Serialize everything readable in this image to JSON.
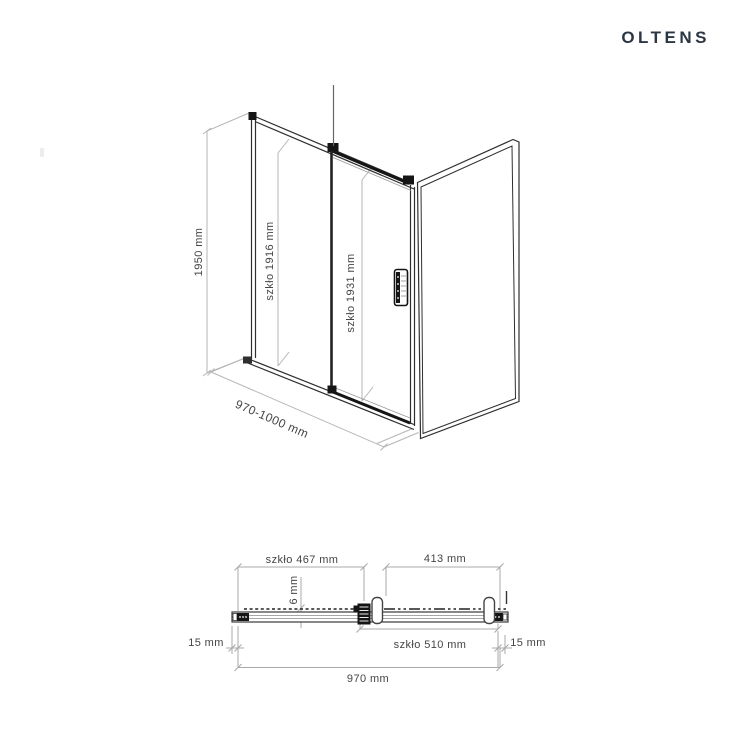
{
  "brand": {
    "logo": "OLTENS",
    "logo_color": "#2c3744"
  },
  "perspective_view": {
    "description": "3D perspective line drawing of sliding shower door with side wall panel",
    "labels": {
      "total_height": "1950 mm",
      "fixed_glass_height": "szkło 1916 mm",
      "door_glass_height": "szkło 1931 mm",
      "width_range": "970-1000 mm"
    }
  },
  "section_view": {
    "description": "Top-down cross-section of door track profile with rollers",
    "labels": {
      "fixed_glass_width": "szkło 467 mm",
      "opening_width": "413 mm",
      "glass_thickness": "6 mm",
      "left_adjustment": "15 mm",
      "door_glass_width": "szkło 510 mm",
      "right_adjustment": "15 mm",
      "total_width": "970 mm"
    }
  },
  "colors": {
    "line_dark": "#2f2f2f",
    "hardware_black": "#151515",
    "dimension_gray": "#a8a8a8",
    "label_gray": "#454545"
  }
}
